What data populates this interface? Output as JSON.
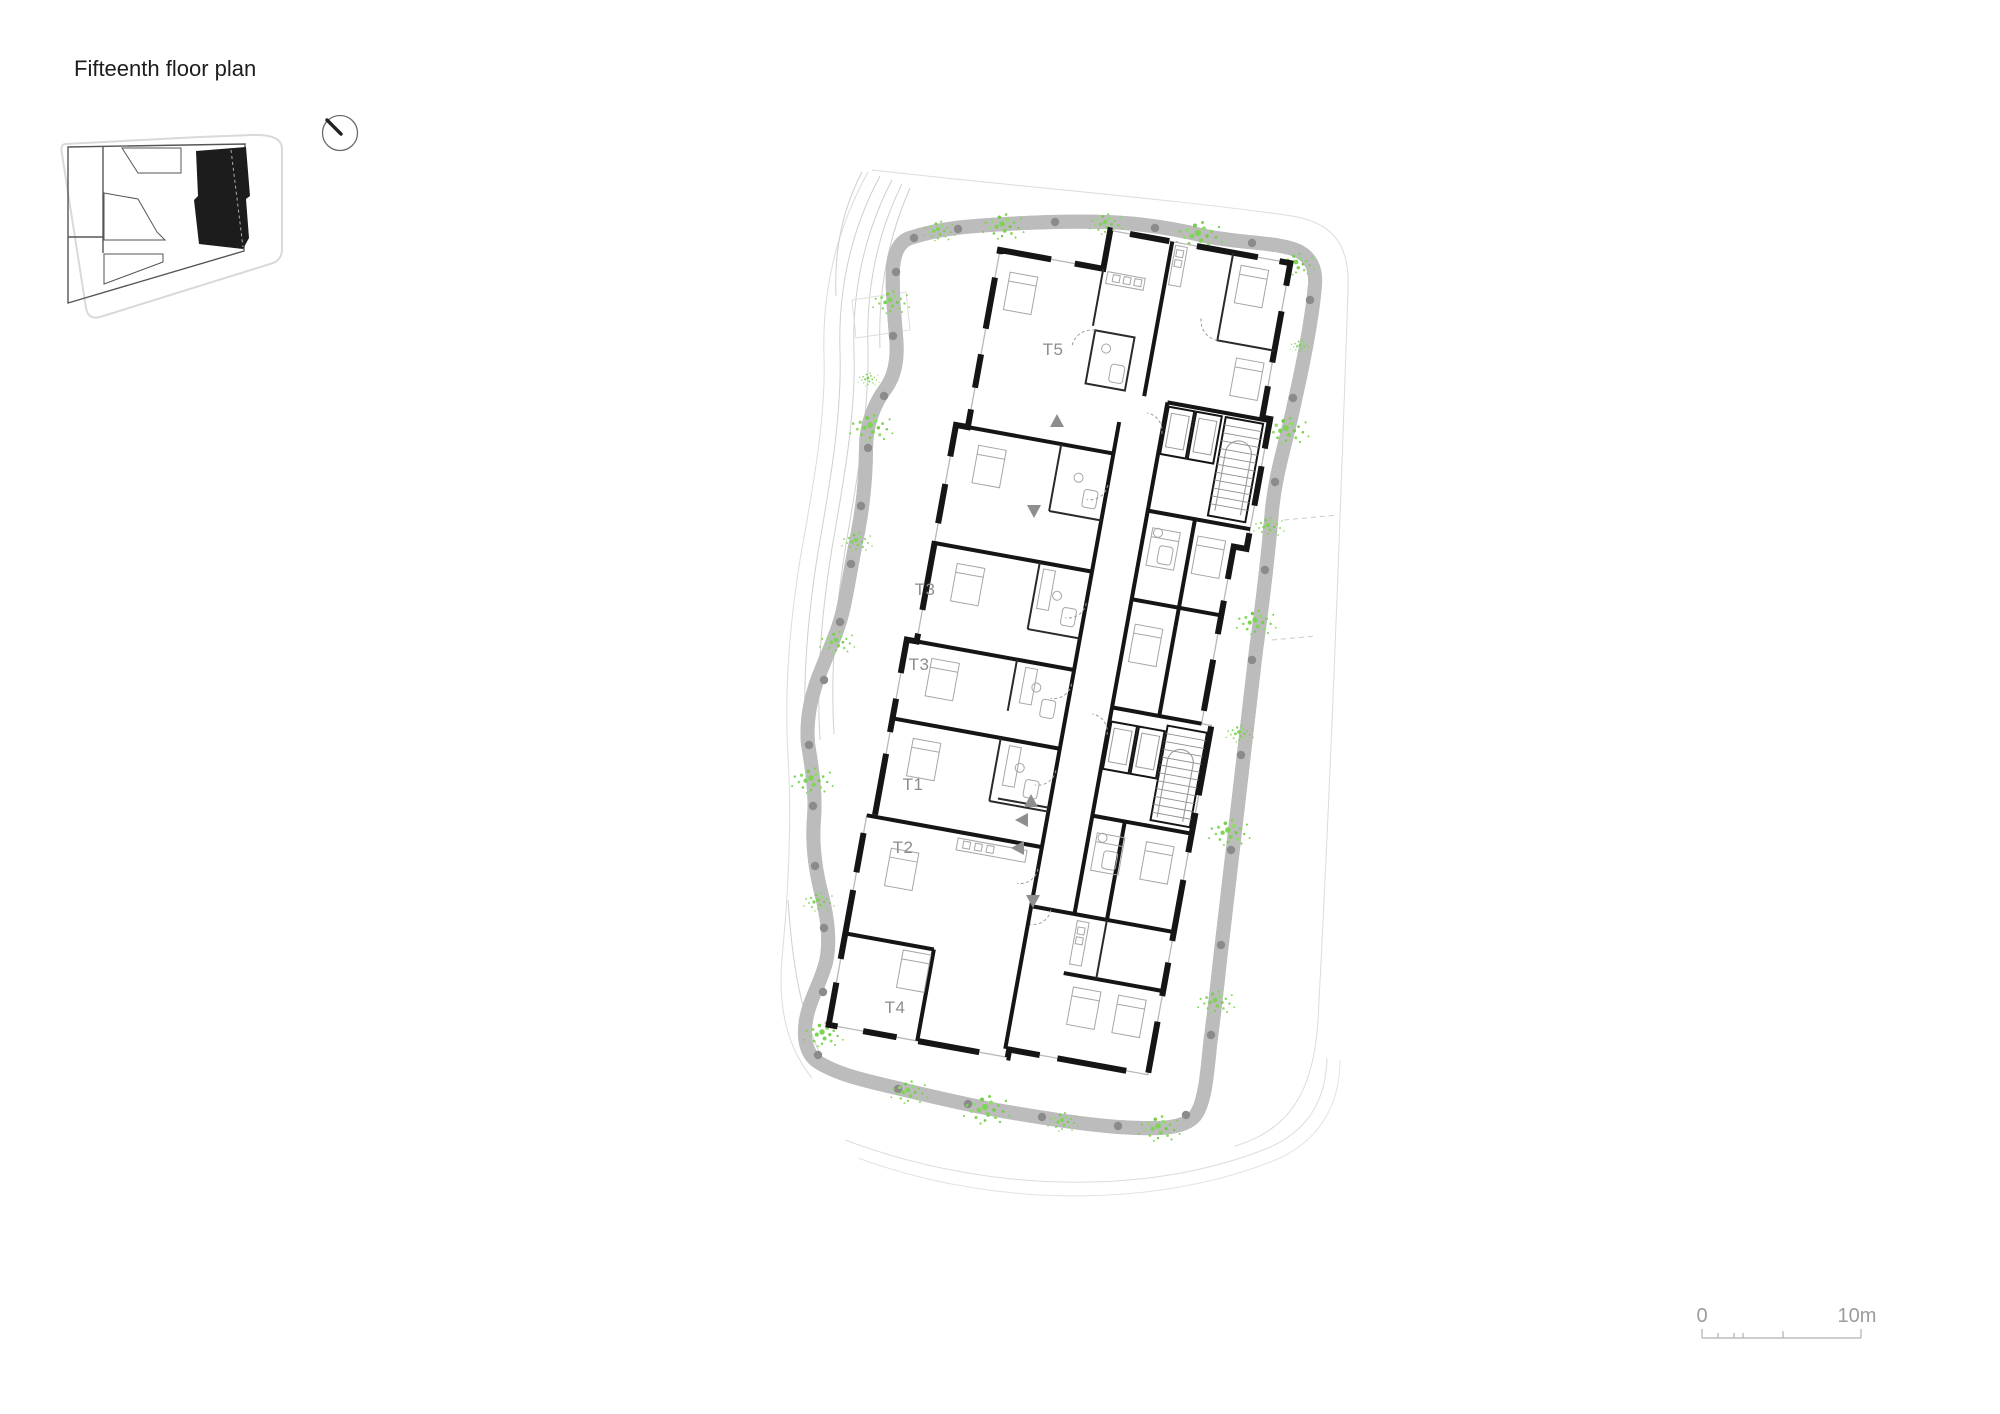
{
  "page": {
    "title": "Fifteenth floor plan"
  },
  "key_plan": {
    "name": "site key plan",
    "highlight_color": "#1c1c1c"
  },
  "north_arrow": {
    "name": "north arrow"
  },
  "floor_plan": {
    "units": [
      {
        "label": "T5"
      },
      {
        "label": "T3"
      },
      {
        "label": "T3"
      },
      {
        "label": "T1"
      },
      {
        "label": "T2"
      },
      {
        "label": "T4"
      }
    ],
    "wall_color": "#151515",
    "landscape_green": "#7fd356",
    "label_color": "#8c8c8c"
  },
  "scale_bar": {
    "zero": "0",
    "max": "10m"
  }
}
